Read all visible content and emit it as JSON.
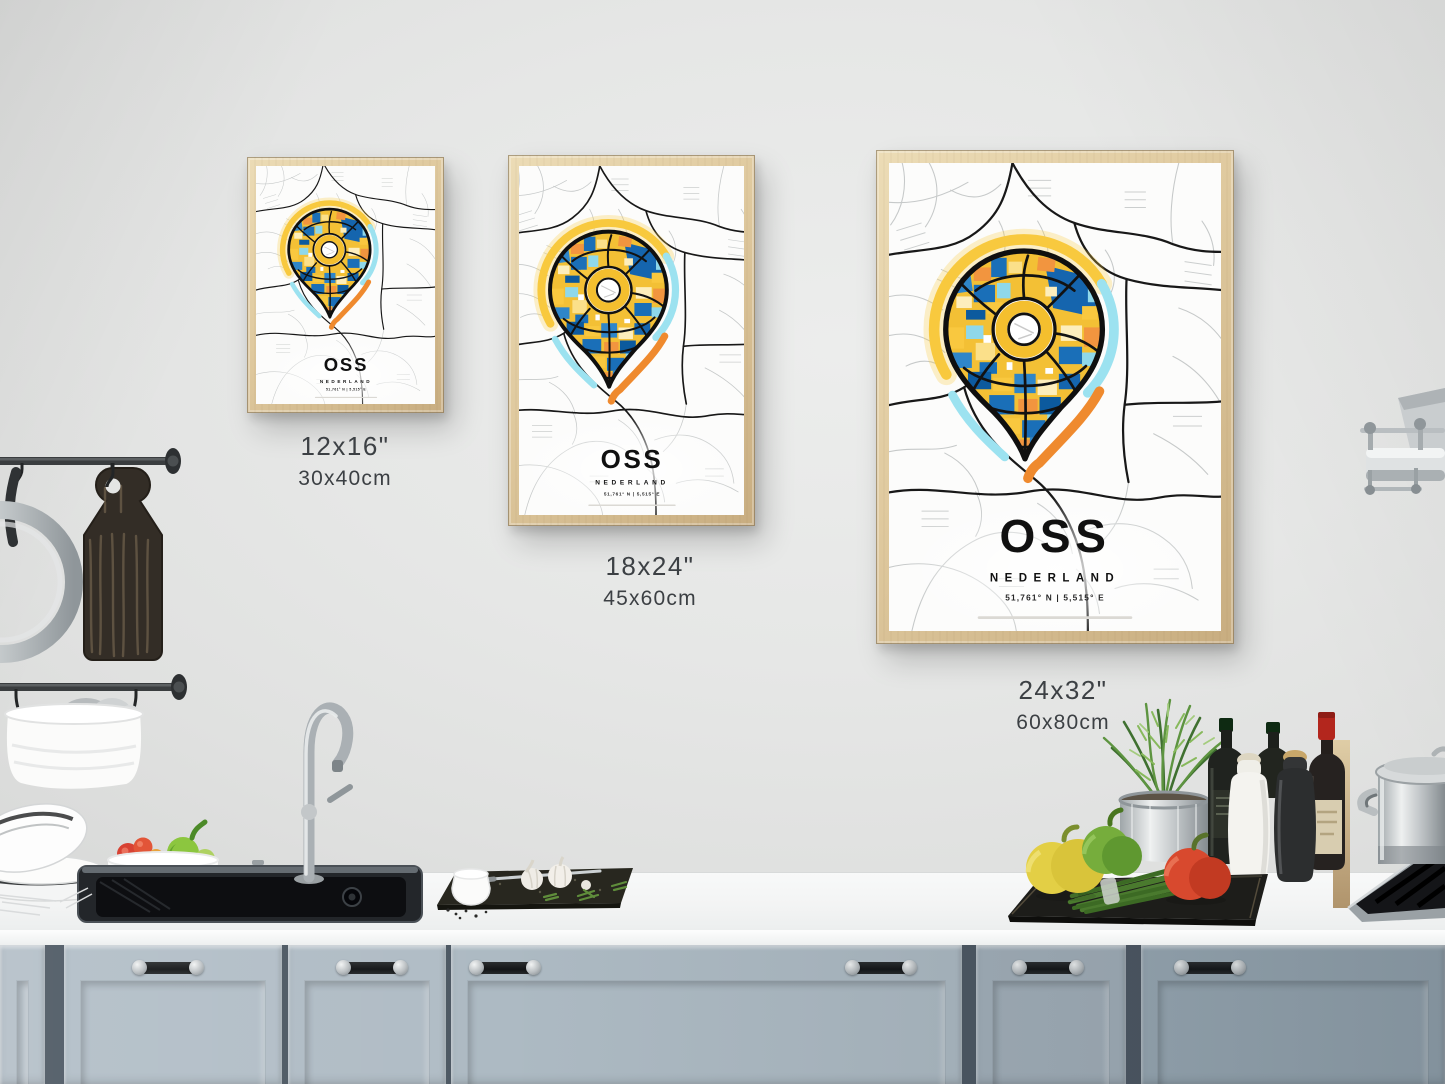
{
  "poster": {
    "title": "OSS",
    "subtitle": "NEDERLAND",
    "coordinates": "51,761° N | 5,515° E"
  },
  "sizes": [
    {
      "inches": "12x16\"",
      "cm": "30x40cm"
    },
    {
      "inches": "18x24\"",
      "cm": "45x60cm"
    },
    {
      "inches": "24x32\"",
      "cm": "60x80cm"
    }
  ],
  "colors": {
    "pin_yellow": "#f6c83d",
    "halo_cyan": "#9ce2f0",
    "halo_orange": "#ef8a2e",
    "map_blue": "#1a6fb8",
    "map_dark_blue": "#0c5a9e",
    "frame_wood": "#dcc69c",
    "cabinet_blue_gray": "#aebac4",
    "wall_gray": "#e5e6e5"
  }
}
